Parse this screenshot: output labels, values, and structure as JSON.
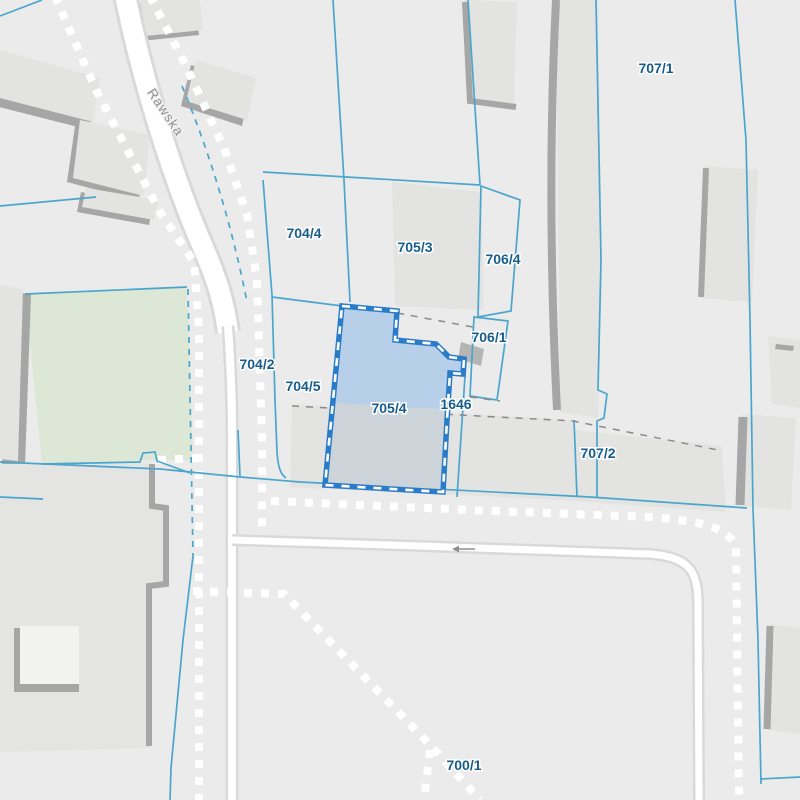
{
  "map": {
    "street": {
      "name": "Rawska"
    },
    "selected_parcel": {
      "id": "705/4"
    },
    "parcel_labels": [
      {
        "id": "707/1",
        "text": "707/1"
      },
      {
        "id": "704/4",
        "text": "704/4"
      },
      {
        "id": "705/3",
        "text": "705/3"
      },
      {
        "id": "706/4",
        "text": "706/4"
      },
      {
        "id": "706/1",
        "text": "706/1"
      },
      {
        "id": "704/2",
        "text": "704/2"
      },
      {
        "id": "704/5",
        "text": "704/5"
      },
      {
        "id": "705/4",
        "text": "705/4"
      },
      {
        "id": "1646",
        "text": "1646"
      },
      {
        "id": "707/2",
        "text": "707/2"
      },
      {
        "id": "700/1",
        "text": "700/1"
      }
    ],
    "road_arrow": {
      "direction": "left"
    },
    "colors": {
      "background": "#ebebeb",
      "building": "#e3e3e1",
      "building_shadow": "#a6a6a6",
      "green_area": "#dde7d5",
      "parcel_line": "#4aa6cd",
      "selection_border": "#2a7cc9",
      "selection_fill_upper": "#b7cfe9",
      "selection_fill_lower": "#ccd3d9",
      "parcel_label_text": "#175d8c",
      "street_label_text": "#8f8f8f",
      "road": "#ffffff",
      "inner_boundary_dashed": "#8a8a8a"
    }
  }
}
